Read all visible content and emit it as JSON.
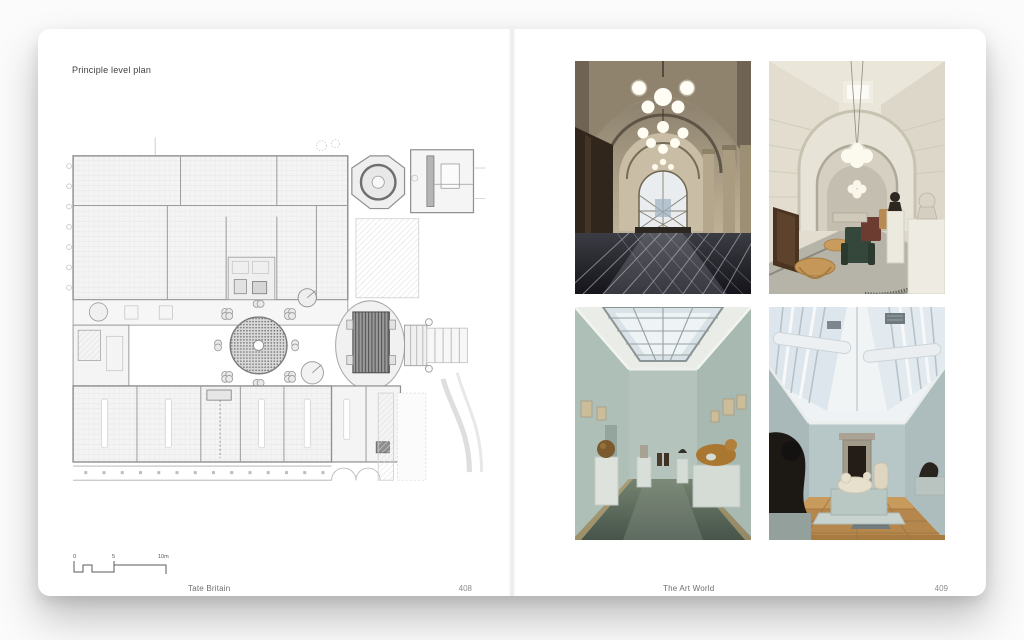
{
  "book": {
    "left_page": {
      "title": "Principle level plan",
      "plan": {
        "subject": "tate-britain-principal-level-floor-plan"
      },
      "scale_bar": {
        "labels": [
          "0",
          "5",
          "10m"
        ]
      },
      "footer": {
        "caption": "Tate Britain",
        "page_number": "408"
      }
    },
    "right_page": {
      "photos": [
        {
          "id": "vaulted-entrance-hall",
          "description": "Stone vaulted hall, globe chandeliers, patterned dark floor, arched window"
        },
        {
          "id": "arched-corridor-lounge",
          "description": "White arched corridor with pendant globes, armchairs, tables and busts"
        },
        {
          "id": "skylit-long-gallery",
          "description": "Pale green gallery with long gridded skylight and sculptures on plinths"
        },
        {
          "id": "toplit-sculpture-room",
          "description": "Barrel skylight room, wood floor, reclining sculpture on pale plinth"
        }
      ],
      "footer": {
        "caption": "The Art World",
        "page_number": "409"
      }
    },
    "colors": {
      "page": "#ffffff",
      "surround": "#fbfbfb",
      "plan_line": "#9d9d9d",
      "plan_dark": "#5a5a5a",
      "stone": "#bdb29a",
      "sage_wall": "#aebfb8",
      "wood_floor": "#b5874d"
    }
  }
}
